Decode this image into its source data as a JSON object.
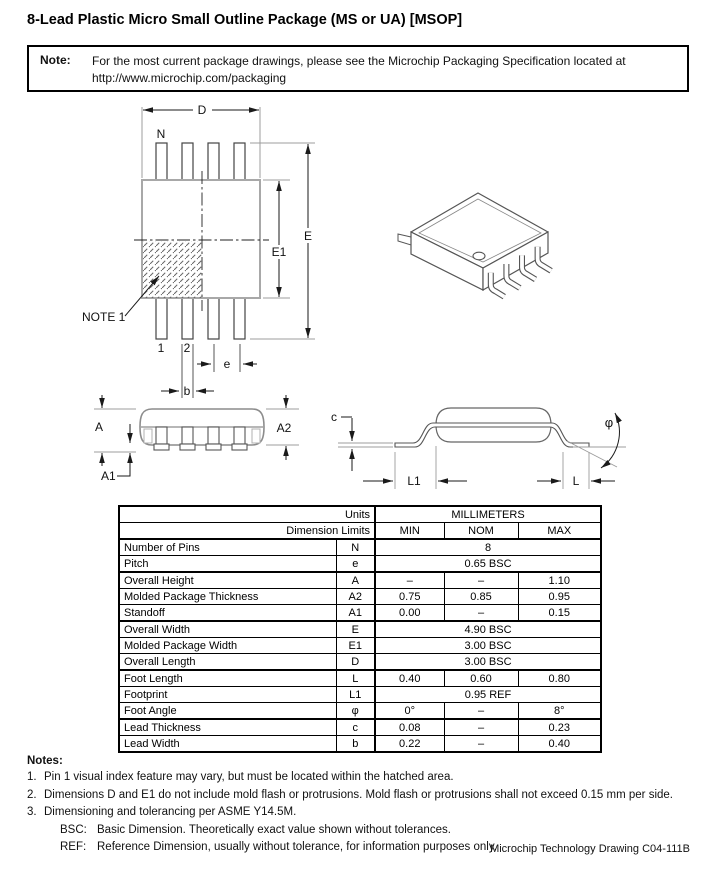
{
  "page": {
    "title": "8-Lead Plastic Micro Small Outline Package (MS or UA) [MSOP]",
    "footer": "Microchip Technology Drawing C04-111B"
  },
  "note_box": {
    "label": "Note:",
    "line1": "For the most current package drawings, please see the Microchip Packaging Specification located at",
    "line2": "http://www.microchip.com/packaging"
  },
  "drawing": {
    "labels": {
      "D": "D",
      "N": "N",
      "E": "E",
      "E1": "E1",
      "note1": "NOTE 1",
      "pin1": "1",
      "pin2": "2",
      "e": "e",
      "b": "b",
      "A": "A",
      "A1": "A1",
      "A2": "A2",
      "c": "c",
      "phi": "φ",
      "L1": "L1",
      "L": "L"
    }
  },
  "table": {
    "units_label": "Units",
    "units_value": "MILLIMETERS",
    "limits_label": "Dimension Limits",
    "col_min": "MIN",
    "col_nom": "NOM",
    "col_max": "MAX",
    "rows": [
      {
        "name": "Number of Pins",
        "symbol": "N",
        "span": "8"
      },
      {
        "name": "Pitch",
        "symbol": "e",
        "span": "0.65 BSC"
      },
      {
        "name": "Overall Height",
        "symbol": "A",
        "min": "–",
        "nom": "–",
        "max": "1.10"
      },
      {
        "name": "Molded Package Thickness",
        "symbol": "A2",
        "min": "0.75",
        "nom": "0.85",
        "max": "0.95"
      },
      {
        "name": "Standoff",
        "symbol": "A1",
        "min": "0.00",
        "nom": "–",
        "max": "0.15"
      },
      {
        "name": "Overall Width",
        "symbol": "E",
        "span": "4.90 BSC"
      },
      {
        "name": "Molded Package Width",
        "symbol": "E1",
        "span": "3.00 BSC"
      },
      {
        "name": "Overall Length",
        "symbol": "D",
        "span": "3.00 BSC"
      },
      {
        "name": "Foot Length",
        "symbol": "L",
        "min": "0.40",
        "nom": "0.60",
        "max": "0.80"
      },
      {
        "name": "Footprint",
        "symbol": "L1",
        "span": "0.95 REF"
      },
      {
        "name": "Foot Angle",
        "symbol": "φ",
        "min": "0°",
        "nom": "–",
        "max": "8°"
      },
      {
        "name": "Lead Thickness",
        "symbol": "c",
        "min": "0.08",
        "nom": "–",
        "max": "0.23"
      },
      {
        "name": "Lead Width",
        "symbol": "b",
        "min": "0.22",
        "nom": "–",
        "max": "0.40"
      }
    ]
  },
  "notes": {
    "heading": "Notes:",
    "items": [
      {
        "num": "1.",
        "text": "Pin 1 visual index feature may vary, but must be located within the hatched area."
      },
      {
        "num": "2.",
        "text": "Dimensions D and E1 do not include mold flash or protrusions. Mold flash or protrusions shall not exceed 0.15 mm per side."
      },
      {
        "num": "3.",
        "text": "Dimensioning and tolerancing per ASME Y14.5M."
      }
    ],
    "definitions": [
      {
        "term": "BSC:",
        "text": "Basic Dimension. Theoretically exact value shown without tolerances."
      },
      {
        "term": "REF:",
        "text": "Reference Dimension, usually without tolerance, for information purposes only."
      }
    ]
  }
}
